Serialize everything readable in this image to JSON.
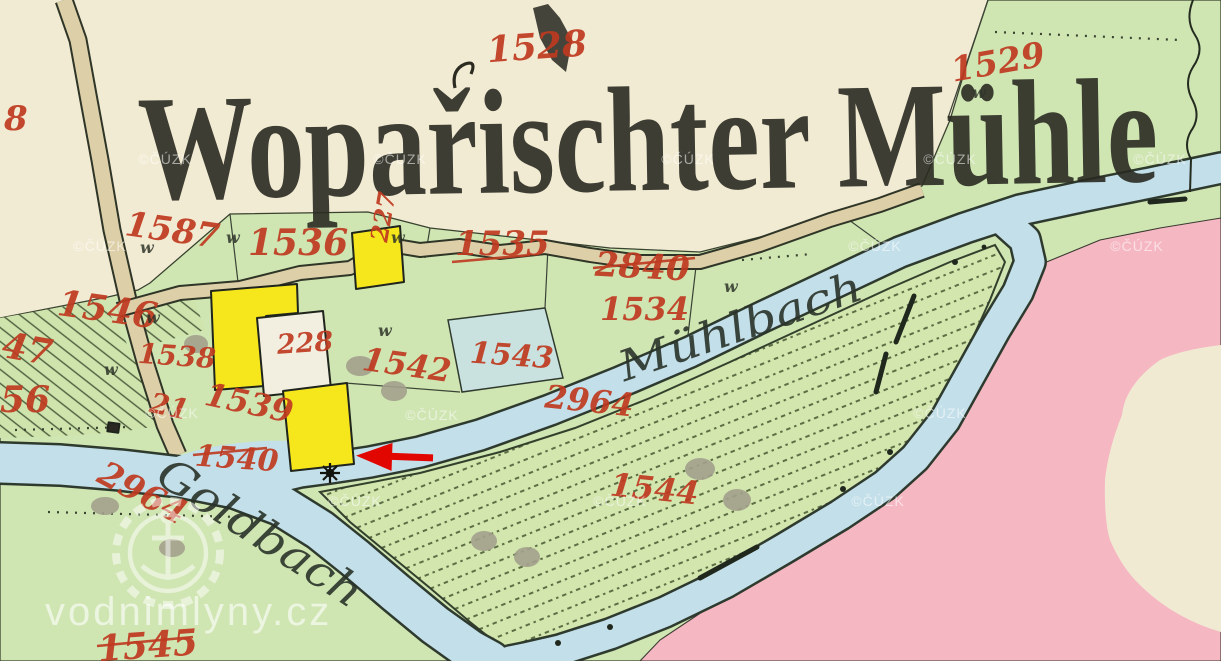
{
  "map": {
    "title": "Wopařischter Mühle",
    "stream_labels": {
      "muhlbach": "Mühlbach",
      "goldbach": "Goldbach"
    },
    "parcels": {
      "p8": "8",
      "p1528": "1528",
      "p1529": "1529",
      "p1587": "1587",
      "p1536": "1536",
      "p227": "227",
      "p1535": "1535",
      "p2840": "2840",
      "p1534": "1534",
      "p1546": "1546",
      "p47": "47",
      "p56": "56",
      "p1538": "1538",
      "p228": "228",
      "p1542": "1542",
      "p1543": "1543",
      "p1539": "1539",
      "p21": "21",
      "p1540": "1540",
      "p2964a": "2964",
      "p2964b": "2964",
      "p1544": "1544",
      "p1545": "1545"
    },
    "meadow_mark": "w",
    "watermarks": {
      "copyright": "©ČÚZK",
      "site": "vodnimlyny.cz"
    },
    "colors": {
      "cream": "#f2ebd3",
      "green": "#cfe5b2",
      "meadow": "#d2e6ae",
      "water": "#c3dfe9",
      "pink": "#f5b8c3",
      "road": "#ddd0a8",
      "building_yellow": "#f6e71c",
      "label_red": "#bf3a20",
      "ink": "#2b3328",
      "arrow_red": "#e10600"
    }
  }
}
